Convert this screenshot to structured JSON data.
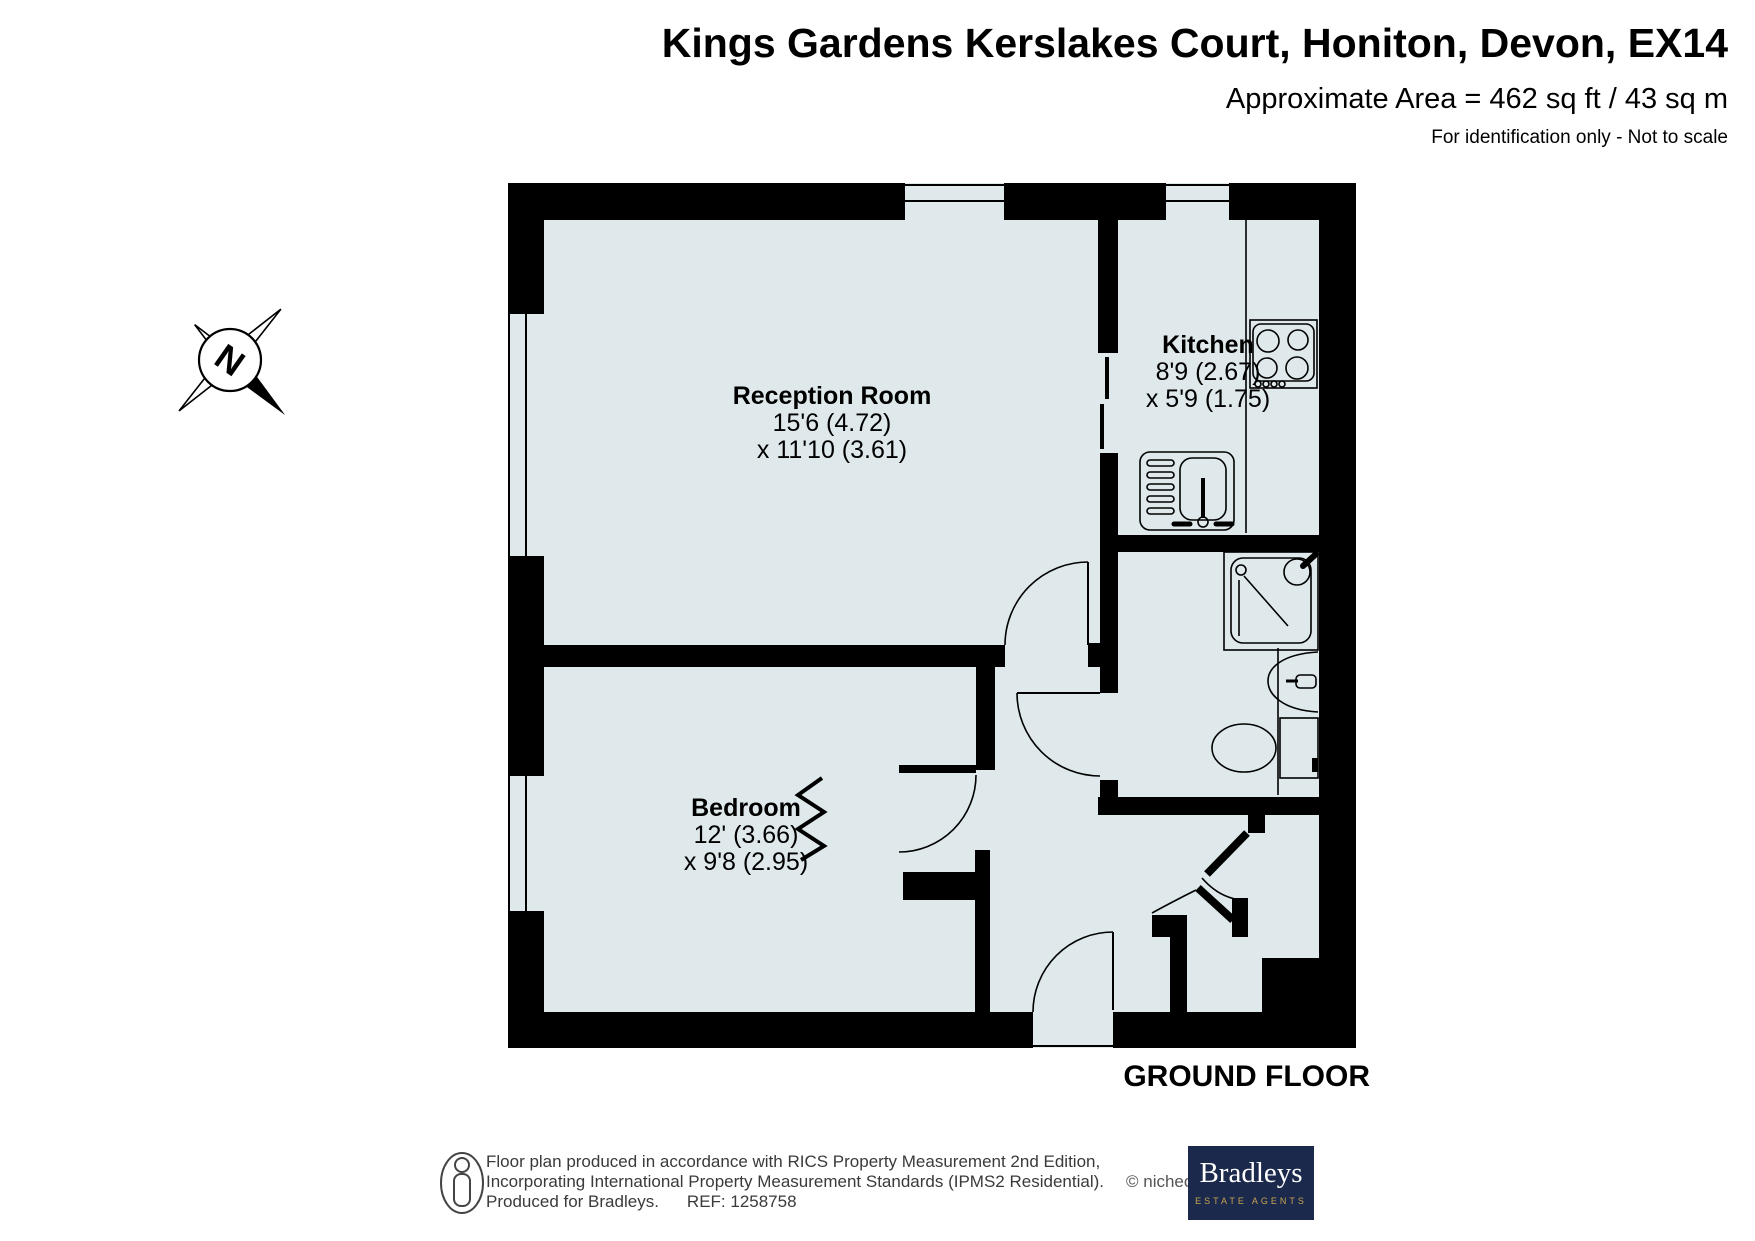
{
  "header": {
    "title": "Kings Gardens Kerslakes Court, Honiton, Devon, EX14",
    "area": "Approximate Area = 462 sq ft / 43 sq m",
    "note": "For identification only - Not to scale"
  },
  "rooms": {
    "reception": {
      "name": "Reception Room",
      "dim1": "15'6 (4.72)",
      "dim2": "x 11'10 (3.61)"
    },
    "kitchen": {
      "name": "Kitchen",
      "dim1": "8'9 (2.67)",
      "dim2": "x 5'9 (1.75)"
    },
    "bedroom": {
      "name": "Bedroom",
      "dim1": "12' (3.66)",
      "dim2": "x 9'8 (2.95)"
    }
  },
  "floor_label": "GROUND FLOOR",
  "compass": {
    "letter": "N"
  },
  "footer": {
    "line1": "Floor plan produced in accordance with RICS Property Measurement 2nd Edition,",
    "line2": "Incorporating International Property Measurement Standards (IPMS2 Residential).",
    "copyright": "© nichecom 2025.",
    "line3": "Produced for Bradleys.",
    "ref": "REF: 1258758",
    "brand": {
      "name": "Bradleys",
      "tagline": "ESTATE AGENTS"
    }
  },
  "colors": {
    "room_fill": "#dfe9eb",
    "wall": "#000000",
    "brand_navy": "#1b2a4c",
    "brand_gold": "#c9a350"
  }
}
